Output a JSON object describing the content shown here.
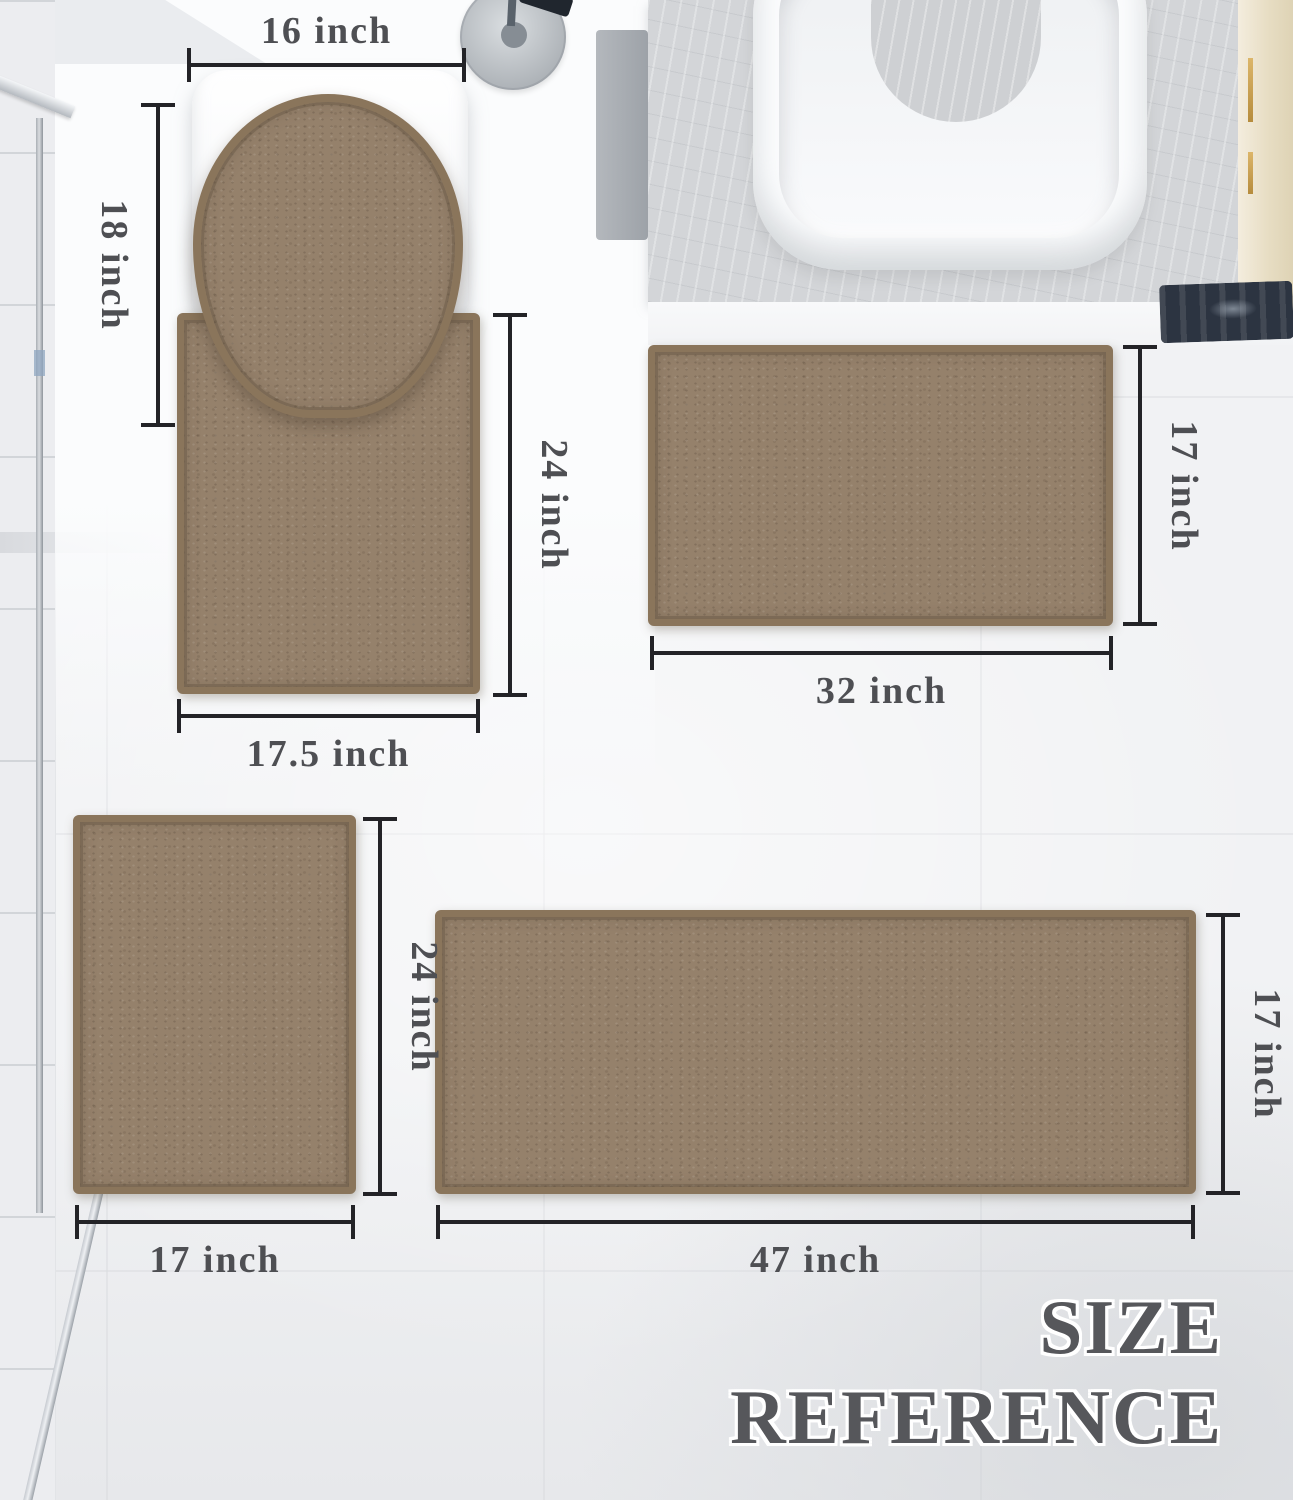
{
  "title": {
    "line1": "SIZE",
    "line2": "REFERENCE"
  },
  "rugs": {
    "lid_cover": {
      "width_label": "16 inch",
      "height_label": "18 inch"
    },
    "contour_rug": {
      "height_label": "24 inch",
      "width_label": "17.5 inch"
    },
    "medium_mat": {
      "width_label": "32 inch",
      "height_label": "17 inch"
    },
    "small_mat": {
      "height_label": "24 inch",
      "width_label": "17 inch"
    },
    "runner": {
      "width_label": "47 inch",
      "height_label": "17 inch"
    }
  },
  "colors": {
    "rug_fill": "#95816b",
    "rug_border": "#8a755b",
    "dimension_line": "#232327",
    "dimension_label": "#4e4f53",
    "title_text": "#56575b",
    "floor": "#f1f2f4",
    "stone_platform": "#d3d5d8",
    "dark_mat": "#2c3441",
    "cabinet": "#e7ddc3"
  }
}
